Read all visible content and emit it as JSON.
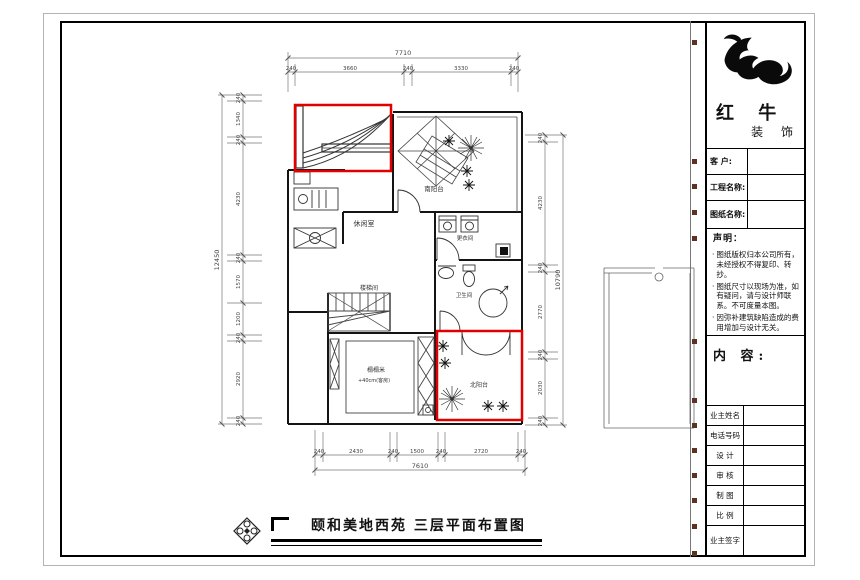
{
  "doc": {
    "bottom_title": "颐和美地西苑 三层平面布置图"
  },
  "brand": {
    "line1": "红 牛",
    "line2": "装 饰"
  },
  "title_block": {
    "fields_top": {
      "customer": "客 户:",
      "project": "工程名称:",
      "drawing": "图纸名称:"
    },
    "statement_heading": "声明：",
    "statement_items": [
      "图纸版权归本公司所有，未经授权不得复印、转抄。",
      "图纸尺寸以现场为准，如有疑问，请与设计师联系。不可度量本图。",
      "因弥补建筑缺陷造成的费用增加与设计无关。"
    ],
    "content_heading": "内 容:",
    "rows": {
      "owner": "业主姓名",
      "phone": "电话号码",
      "design": "设 计",
      "review": "审 核",
      "draft": "制 图",
      "scale": "比 例",
      "sign": "业主签字"
    }
  },
  "plan": {
    "rooms": {
      "leisure": "休闲室",
      "south_balcony": "南阳台",
      "dressing": "更衣间",
      "bath": "卫生间",
      "stair": "楼梯间",
      "tatami": "榻榻米",
      "tatami_note": "+40cm(客房)",
      "north_balcony": "北阳台"
    },
    "dims": {
      "top_total": "7710",
      "top": [
        "240",
        "3660",
        "240",
        "3330",
        "240"
      ],
      "bottom_total": "7610",
      "bottom": [
        "240",
        "2430",
        "240",
        "1500",
        "240",
        "2720",
        "240"
      ],
      "left_total": "12450",
      "left": [
        "240",
        "1340",
        "240",
        "4230",
        "240",
        "1570",
        "1200",
        "240",
        "2920",
        "240"
      ],
      "right_total": "10790",
      "right": [
        "240",
        "4230",
        "240",
        "2770",
        "240",
        "2030",
        "240"
      ]
    },
    "highlight_color": "#e10000"
  }
}
